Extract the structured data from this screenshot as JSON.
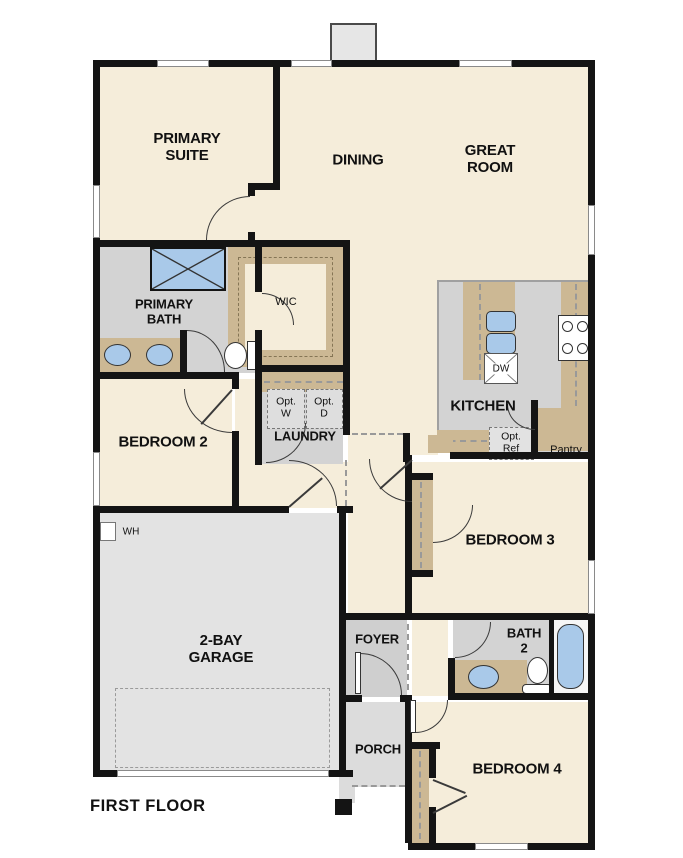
{
  "plan": {
    "title": "FIRST FLOOR",
    "rooms": {
      "primary_suite": "PRIMARY\nSUITE",
      "dining": "DINING",
      "great_room": "GREAT\nROOM",
      "primary_bath": "PRIMARY\nBATH",
      "wic": "WIC",
      "bedroom_2": "BEDROOM 2",
      "laundry": "LAUNDRY",
      "kitchen": "KITCHEN",
      "pantry": "Pantry",
      "bedroom_3": "BEDROOM 3",
      "garage": "2-BAY\nGARAGE",
      "foyer": "FOYER",
      "bath_2": "BATH\n2",
      "porch": "PORCH",
      "bedroom_4": "BEDROOM 4"
    },
    "appliances": {
      "opt_washer": "Opt.\nW",
      "opt_dryer": "Opt.\nD",
      "opt_refrigerator": "Opt.\nRef",
      "dishwasher": "DW",
      "water_heater": "WH"
    },
    "colors": {
      "floor_cream": "#f5edda",
      "floor_gray": "#d3d3d3",
      "floor_garage": "#e3e3e3",
      "floor_porch": "#dcdcdc",
      "counter_tan": "#ccb894",
      "fixture_blue": "#a9c9e9",
      "wall_black": "#141414",
      "background": "#ffffff"
    }
  }
}
